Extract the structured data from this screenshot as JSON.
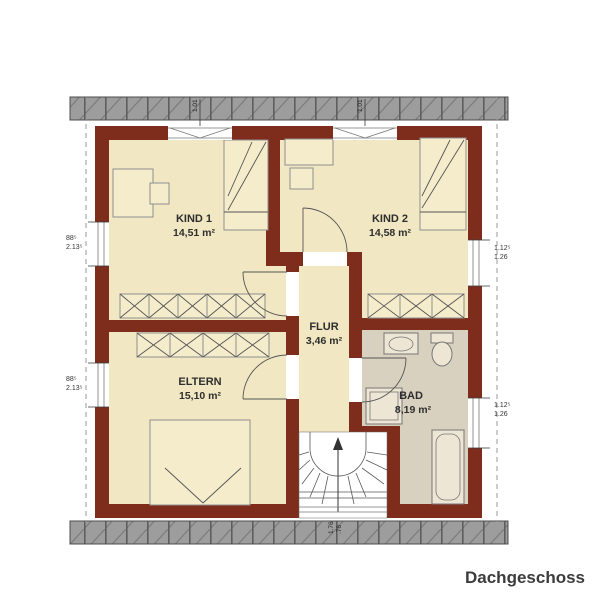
{
  "title": "Dachgeschoss",
  "rooms": {
    "kind1": {
      "name": "KIND 1",
      "area": "14,51 m²"
    },
    "kind2": {
      "name": "KIND 2",
      "area": "14,58 m²"
    },
    "flur": {
      "name": "FLUR",
      "area": "3,46 m²"
    },
    "eltern": {
      "name": "ELTERN",
      "area": "15,10 m²"
    },
    "bad": {
      "name": "BAD",
      "area": "8,19 m²"
    }
  },
  "dimensions": {
    "window_left_top_l1": "88⁵",
    "window_left_top_l2": "2.13⁵",
    "window_left_bottom_l1": "88⁵",
    "window_left_bottom_l2": "2.13⁵",
    "window_right_top_l1": "1.12⁵",
    "window_right_top_l2": "1.26",
    "window_right_bottom_l1": "1.12⁵",
    "window_right_bottom_l2": "1.26",
    "window_top_kind1": "1.01",
    "window_top_kind2": "1.01",
    "stair_window_l1": "1.76",
    "stair_window_l2": ".76"
  },
  "colors": {
    "wall": "#7E2D1C",
    "floor": "#F2E7C3",
    "bad_floor": "#D9D1BF",
    "roof_band": "#9D9D9D"
  }
}
